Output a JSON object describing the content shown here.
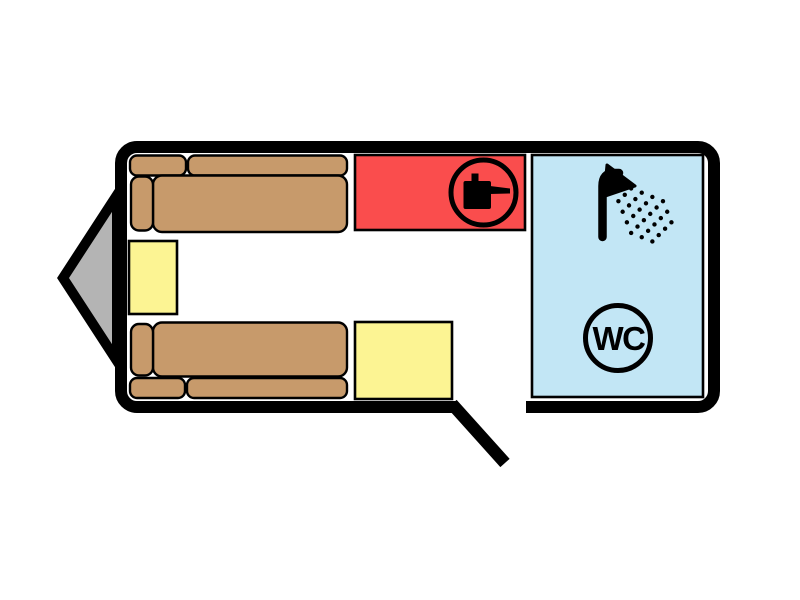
{
  "diagram": {
    "type": "caravan-floorplan",
    "wc_label": "WC"
  },
  "colors": {
    "background": "#ffffff",
    "wall": "#000000",
    "hitch": "#b4b4b4",
    "sofa": "#c79a6b",
    "table": "#fcf493",
    "kitchen": "#fa4d4d",
    "bathroom": "#c2e6f5",
    "icon": "#000000"
  },
  "icons": {
    "kitchen_hob": "cooking-pot-icon",
    "shower": "shower-icon",
    "toilet": "wc-badge"
  }
}
